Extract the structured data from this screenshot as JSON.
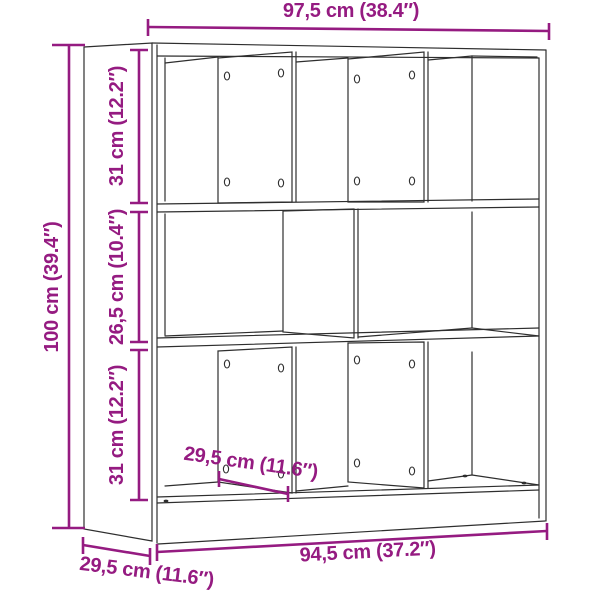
{
  "diagram": {
    "subject": "bookcase-dimension-drawing",
    "accent_color": "#951b81",
    "line_color": "#2e2e2e",
    "background": "#ffffff",
    "labels": {
      "overall_width": "97,5 cm (38.4″)",
      "overall_height": "100 cm (39.4″)",
      "top_row_height": "31 cm (12.2″)",
      "middle_row_height": "26,5 cm (10.4″)",
      "bottom_row_height": "31 cm (12.2″)",
      "inner_width": "94,5 cm (37.2″)",
      "outer_depth": "29,5 cm (11.6″)",
      "inner_depth": "29,5 cm (11.6″)"
    }
  }
}
